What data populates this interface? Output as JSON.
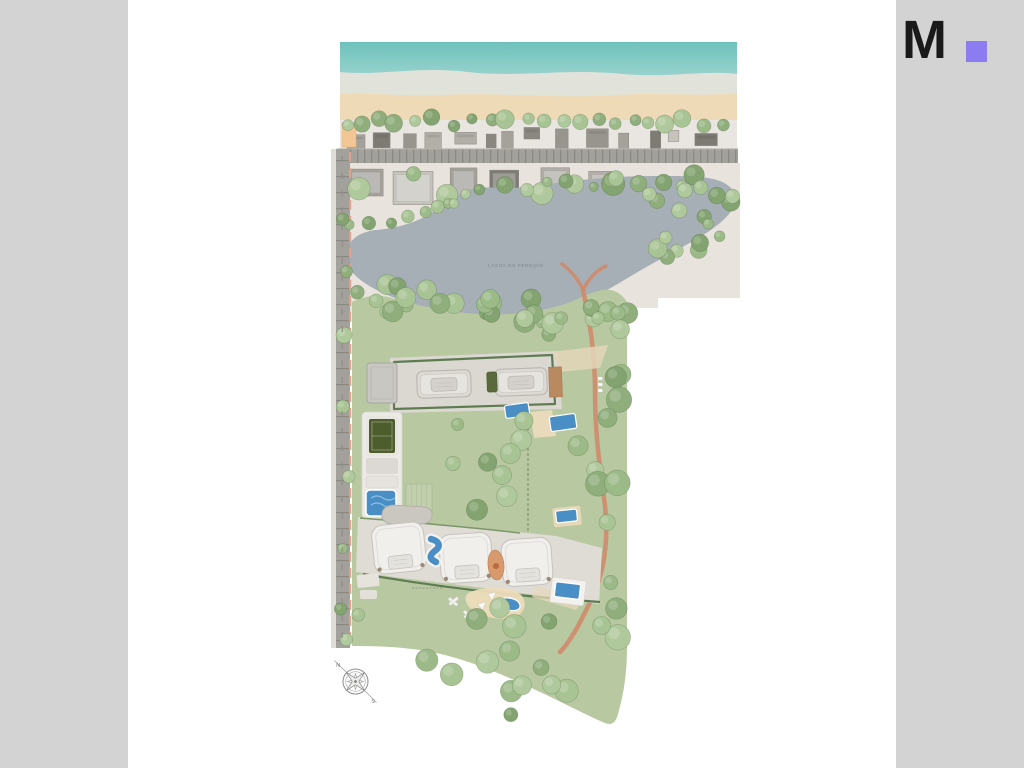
{
  "page": {
    "background": "#ffffff",
    "frame_color": "#d3d3d3"
  },
  "logo": {
    "letter": "M",
    "letter_color": "#1a1a1a",
    "dot_color": "#8c7bf1"
  },
  "map": {
    "labels": {
      "lagoon": "LAGOA DO PEREQUÊ"
    },
    "compass": {
      "north": "N",
      "south": "S"
    },
    "colors": {
      "sea": "#74c4bf",
      "sea_light": "#a5d8d2",
      "foam": "#e1e3db",
      "sand": "#eedab6",
      "beach_strip": "#e9e6e1",
      "road": "#a3a19b",
      "road_tick": "#8b8983",
      "sidewalk": "#e0ddd7",
      "curb_line": "#eda089",
      "land": "#e8e4dd",
      "lagoon": "#a6afb5",
      "lagoon_text": "#7e868a",
      "green": "#b8c9a2",
      "hedge": "#5e7b52",
      "pavement": "#dbd8d2",
      "court_green": "#4e5d2c",
      "court_gray": "#c9c7c2",
      "pool": "#4a8ec6",
      "pool_light": "#8fc0e4",
      "path": "#cf8a6c",
      "building": "#dcd9d4",
      "building_light": "#f1efec",
      "deck": "#b9895f",
      "sand_pad": "#ecdcba",
      "peach_lot": "#f2c793",
      "tree_palette": [
        "#9cba88",
        "#8fae7c",
        "#a8c494",
        "#83a370",
        "#b0c99c"
      ]
    }
  }
}
